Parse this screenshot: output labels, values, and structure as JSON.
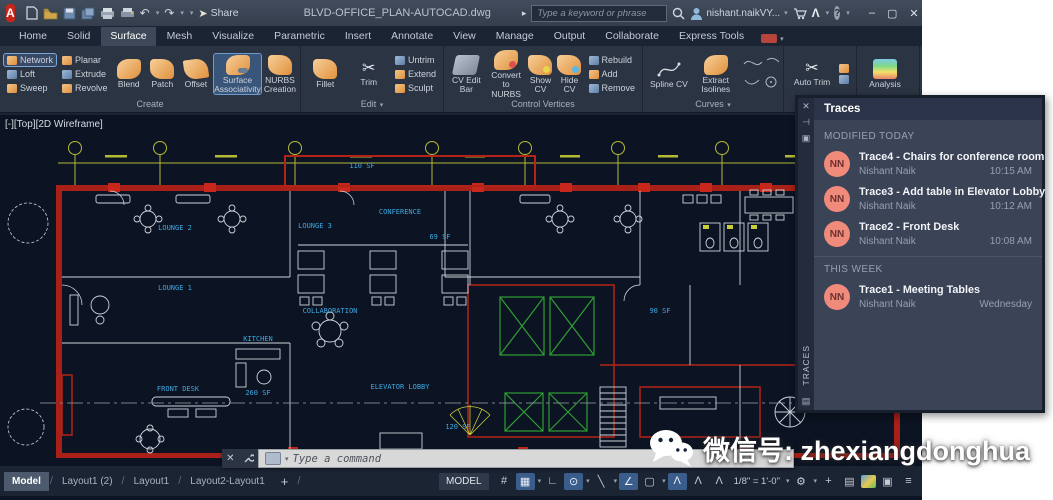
{
  "icons": {
    "close": "✕",
    "minimize": "–",
    "maximize": "▢",
    "caret": "▾",
    "play": "▸",
    "hamburger": "≡",
    "gear": "⚙",
    "plus": "+",
    "grid": "#",
    "snap_grid": "▦",
    "ortho": "∟",
    "polar": "⊙",
    "isoplane": "╲",
    "osnap": "∠",
    "box": "▢",
    "annot": "Λ",
    "slash": "/",
    "pin": "⊣",
    "panel": "▣",
    "tray": "▤",
    "undo": "↶",
    "redo": "↷",
    "share_plane": "➤",
    "scissors": "✂",
    "zebra": ")))",
    "app_letter": "A",
    "autodesk": "Λ",
    "help": "?",
    "x_small": "✕",
    "clean": "▣"
  },
  "titlebar": {
    "filename": "BLVD-OFFICE_PLAN-AUTOCAD.dwg",
    "share": "Share",
    "search_placeholder": "Type a keyword or phrase",
    "user": "nishant.naikVY..."
  },
  "ribbon": {
    "tabs": [
      "Home",
      "Solid",
      "Surface",
      "Mesh",
      "Visualize",
      "Parametric",
      "Insert",
      "Annotate",
      "View",
      "Manage",
      "Output",
      "Collaborate",
      "Express Tools"
    ],
    "panels": {
      "create": {
        "label": "Create",
        "items": [
          "Network",
          "Planar",
          "Loft",
          "Extrude",
          "Sweep",
          "Revolve"
        ],
        "big": [
          "Blend",
          "Patch",
          "Offset"
        ],
        "assoc": "Surface Associativity",
        "nurbs": "NURBS Creation"
      },
      "edit": {
        "label": "Edit",
        "big": [
          "Fillet",
          "Trim"
        ],
        "small": [
          "Untrim",
          "Extend",
          "Sculpt"
        ]
      },
      "cv": {
        "label": "Control Vertices",
        "big": [
          "CV Edit Bar",
          "Convert to NURBS",
          "Show CV",
          "Hide CV"
        ],
        "small": [
          "Rebuild",
          "Add",
          "Remove"
        ]
      },
      "curves": {
        "label": "Curves",
        "big": [
          "Spline CV",
          "Extract Isolines"
        ]
      },
      "project": {
        "label": "Project",
        "big": [
          "Auto Trim"
        ]
      },
      "analysis": {
        "label": "Analysis",
        "big": [
          "Analysis"
        ]
      }
    }
  },
  "doc_tabs": {
    "start": "Start",
    "active": "BLVD OFFICE PLAN-AUTOCAD*"
  },
  "viewport_label": "[-][Top][2D Wireframe]",
  "plan": {
    "labels": {
      "lounge1": "LOUNGE 1",
      "lounge2": "LOUNGE 2",
      "lounge3": "LOUNGE 3",
      "conference": "CONFERENCE",
      "collaboration": "COLLABORATION",
      "front_desk": "FRONT DESK",
      "kitchen": "KITCHEN",
      "kitchen_sf": "260 SF",
      "elevator": "ELEVATOR LOBBY",
      "sf110": "110 SF",
      "sf69": "69 SF",
      "sf90": "90 SF",
      "sf120": "120 SF"
    }
  },
  "command": {
    "placeholder": "Type a command"
  },
  "layout_bar": {
    "tabs": [
      "Model",
      "Layout1 (2)",
      "Layout1",
      "Layout2-Layout1"
    ]
  },
  "status": {
    "model": "MODEL",
    "scale": "1/8\" = 1'-0\""
  },
  "traces": {
    "title": "Traces",
    "side_label": "TRACES",
    "sections": [
      {
        "heading": "MODIFIED TODAY",
        "items": [
          {
            "initials": "NN",
            "title": "Trace4 - Chairs for conference room",
            "author": "Nishant Naik",
            "time": "10:15 AM"
          },
          {
            "initials": "NN",
            "title": "Trace3 - Add table in Elevator Lobby",
            "author": "Nishant Naik",
            "time": "10:12 AM"
          },
          {
            "initials": "NN",
            "title": "Trace2 - Front Desk",
            "author": "Nishant Naik",
            "time": "10:08 AM"
          }
        ]
      },
      {
        "heading": "THIS WEEK",
        "items": [
          {
            "initials": "NN",
            "title": "Trace1 - Meeting Tables",
            "author": "Nishant Naik",
            "time": "Wednesday"
          }
        ]
      }
    ]
  },
  "watermark": {
    "text": "微信号: zhexiangdonghua"
  },
  "colors": {
    "avatar": "#f08a7a",
    "highlight_blue": "#3a5d8c",
    "wall_red": "#b42318",
    "dim_yellow": "#b5ba35",
    "label_blue": "#3fa8e0"
  }
}
